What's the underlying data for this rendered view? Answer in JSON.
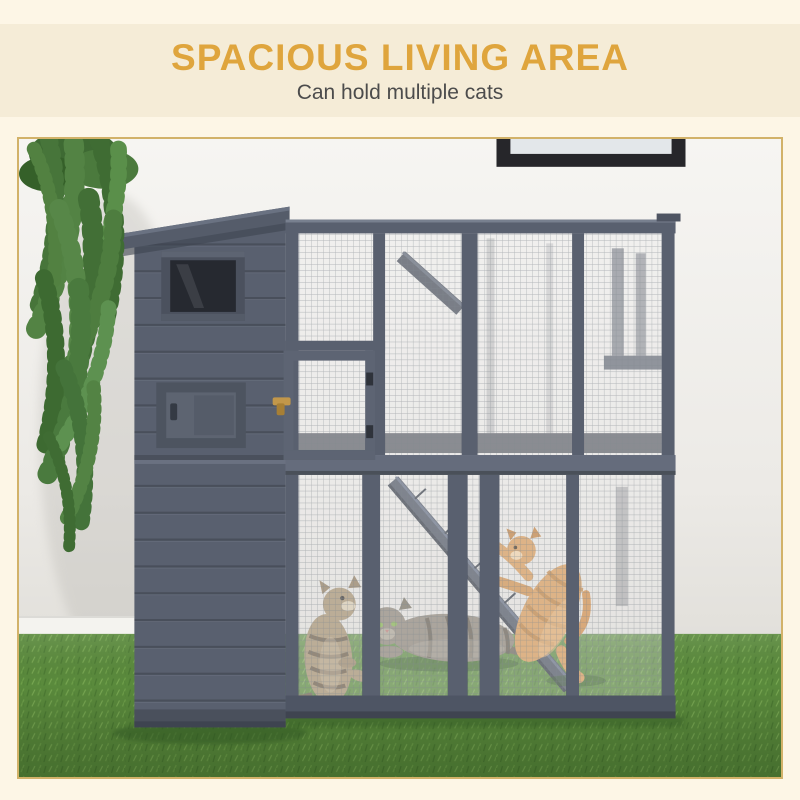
{
  "header": {
    "title": "SPACIOUS LIVING AREA",
    "subtitle": "Can hold multiple cats"
  },
  "scene": {
    "objects": [
      "hanging-plant",
      "picture-frame",
      "cat-enclosure",
      "wood-cabin",
      "mesh-panels",
      "access-door",
      "ramp",
      "sitting-cat",
      "lying-cat",
      "jumping-cat",
      "artificial-grass"
    ]
  },
  "colors": {
    "page_bg": "#fdf6e6",
    "band_bg": "#f5ecd7",
    "title": "#dfa53d",
    "subtitle": "#4c4c4c",
    "photo_border": "#d2b269",
    "wall": "#f3f2ef",
    "grass": "#5a8a3c",
    "structure": "#59606f",
    "picture_frame": "#26262a",
    "latch": "#c2974a",
    "plant": "#4e7d3f",
    "cat_orange": "#d79a57",
    "cat_tabby": "#a5906e",
    "cat_gray": "#8d8578"
  }
}
